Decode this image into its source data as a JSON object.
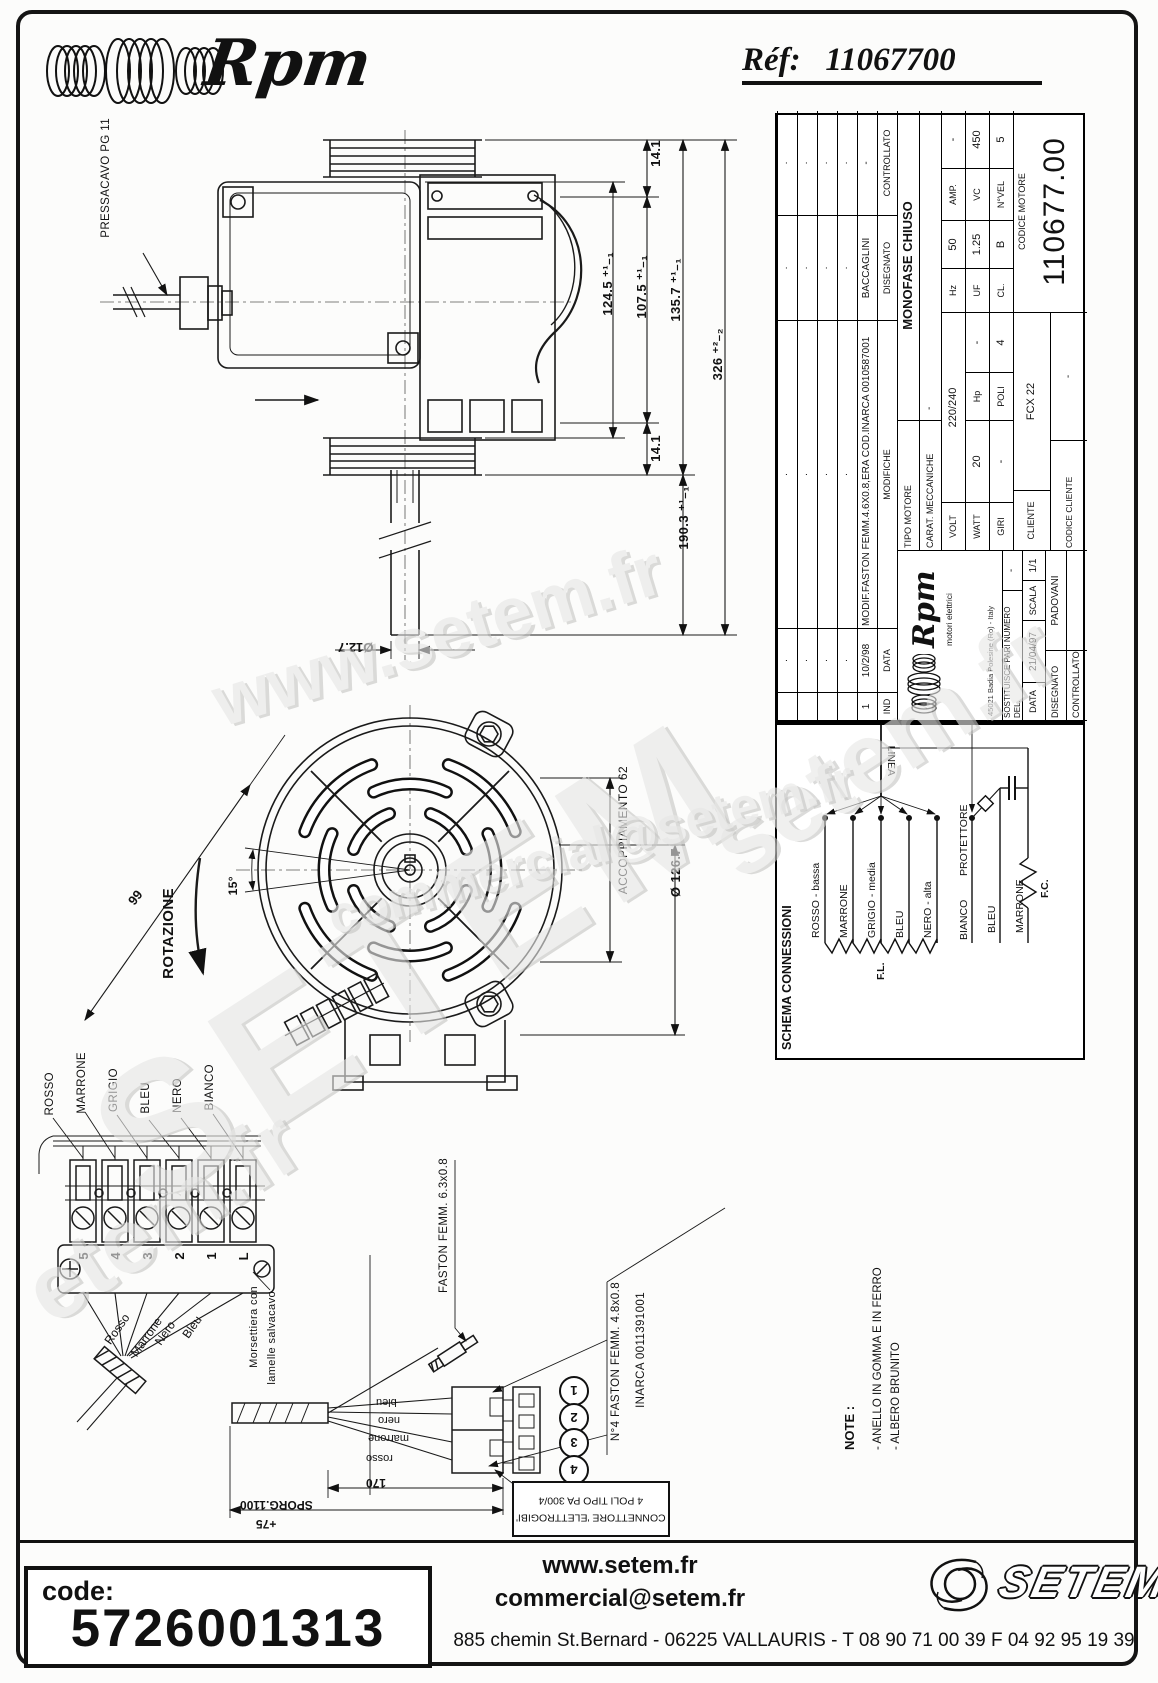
{
  "header": {
    "brand": "Rpm",
    "ref_label": "Réf:",
    "ref_value": "11067700"
  },
  "watermarks": {
    "wm1": "www.setem.fr",
    "wm2": "SETEM",
    "wm3": "setem.fr",
    "wm4": "commercial@setem.fr",
    "wm5": "etem.fr"
  },
  "side_view": {
    "pressacavo": "PRESSACAVO PG 11",
    "dim_14_1_top": "14.1",
    "dim_124_5": "124.5 ⁺¹₋₁",
    "dim_107_5": "107.5 ⁺¹₋₁",
    "dim_135_7": "135.7 ⁺¹₋₁",
    "dim_326": "326 ⁺²₋₂",
    "dim_14_1_bottom": "14.1",
    "dim_190_3": "190.3 ⁺¹₋₁",
    "dim_shaft": "Ø12.7"
  },
  "front_view": {
    "rotazione": "ROTAZIONE",
    "angle": "15°",
    "dim_99": "99",
    "accoppiamento": "ACCOPPIAMENTO 62",
    "diametro": "Ø 126.7"
  },
  "terminal_block": {
    "wire_labels": [
      "ROSSO",
      "MARRONE",
      "GRIGIO",
      "BLEU",
      "NERO",
      "BIANCO"
    ],
    "numbers": [
      "5",
      "4",
      "3",
      "2",
      "1",
      "L"
    ],
    "wire_names": [
      "Rosso",
      "Marrone",
      "Nero",
      "Bleu"
    ],
    "caption_line1": "Morsettiera con",
    "caption_line2": "lamelle salvacavo"
  },
  "connector": {
    "faston_label": "FASTON FEMM. 6.3x0.8",
    "faston4_label": "N°4 FASTON FEMM. 4.8x0.8",
    "faston4_code": "INARCA 0011391001",
    "wires": [
      "bleu",
      "nero",
      "marrone",
      "rosso"
    ],
    "pins": [
      "1",
      "2",
      "3",
      "4"
    ],
    "dim_170": "170",
    "dim_sporg": "SPORG.1100",
    "dim_75": "+75",
    "box_line1": "CONNETTORE 'ELETTROGIBI'",
    "box_line2": "4 POLI TIPO PA 300/4"
  },
  "note": {
    "title": "NOTE :",
    "item1": "- ANELLO IN GOMMA E IN FERRO",
    "item2": "- ALBERO BRUNITO"
  },
  "title_block": {
    "revision": {
      "dot": "·",
      "col_ind": "IND",
      "col_data": "DATA",
      "col_modifiche": "MODIFICHE",
      "col_disegnato": "DISEGNATO",
      "col_controllato": "CONTROLLATO",
      "row1_ind": "1",
      "row1_data": "10/2/98",
      "row1_modifiche": "MODIF.FASTON FEMM.4.6X0.8,ERA COD.INARCA 0010587001",
      "row1_disegnato": "BACCAGLINI",
      "row1_controllato": "-"
    },
    "company": {
      "brand": "Rpm",
      "tagline": "motori elettrici",
      "address": "45021 Badia Polesine (Ro) - Italy"
    },
    "sostituisce_label": "SOSTITUISCE PARI NUMERO DEL.",
    "sostituisce_value": "-",
    "data_label": "DATA",
    "data_value": "21/04/97",
    "scala_label": "SCALA",
    "scala_value": "1/1",
    "disegnato_label": "DISEGNATO",
    "disegnato_value": "PADOVANI",
    "controllato_label": "CONTROLLATO",
    "controllato_value": "",
    "tipo_motore_label": "TIPO MOTORE",
    "tipo_motore_value": "MONOFASE CHIUSO",
    "carat_label": "CARAT. MECCANICHE",
    "carat_value": "-",
    "volt_label": "VOLT",
    "volt_value": "220/240",
    "hz_label": "Hz",
    "hz_value": "50",
    "amp_label": "AMP.",
    "amp_value": "-",
    "watt_label": "WATT",
    "watt_value": "20",
    "hp_label": "Hp",
    "hp_value": "-",
    "uf_label": "UF",
    "uf_value": "1.25",
    "vc_label": "VC",
    "vc_value": "450",
    "giri_label": "GIRI",
    "giri_value": "-",
    "poli_label": "POLI",
    "poli_value": "4",
    "cl_label": "CL.",
    "cl_value": "B",
    "nvel_label": "N°VEL",
    "nvel_value": "5",
    "cliente_label": "CLIENTE",
    "cliente_value": "FCX 22",
    "codice_cliente_label": "CODICE CLIENTE",
    "codice_cliente_value": "-",
    "codice_motore_label": "CODICE MOTORE",
    "codice_motore_value": "110677.00"
  },
  "schema": {
    "title": "SCHEMA CONNESSIONI",
    "linea": "LINEA",
    "wires": [
      "ROSSO - bassa",
      "MARRONE",
      "GRIGIO - media",
      "BLEU",
      "NERO - alta"
    ],
    "wire_bianco": "BIANCO",
    "wire_protettore": "PROTETTORE",
    "wire_bleu2": "BLEU",
    "wire_marrone2": "MARRONE",
    "fl": "F.L.",
    "fc": "F.C."
  },
  "footer": {
    "code_label": "code:",
    "code_value": "5726001313",
    "web": "www.setem.fr",
    "email": "commercial@setem.fr",
    "address": "885 chemin St.Bernard  -  06225 VALLAURIS  -  T 08 90 71 00 39   F 04 92 95 19 39",
    "brand": "SETEM"
  }
}
